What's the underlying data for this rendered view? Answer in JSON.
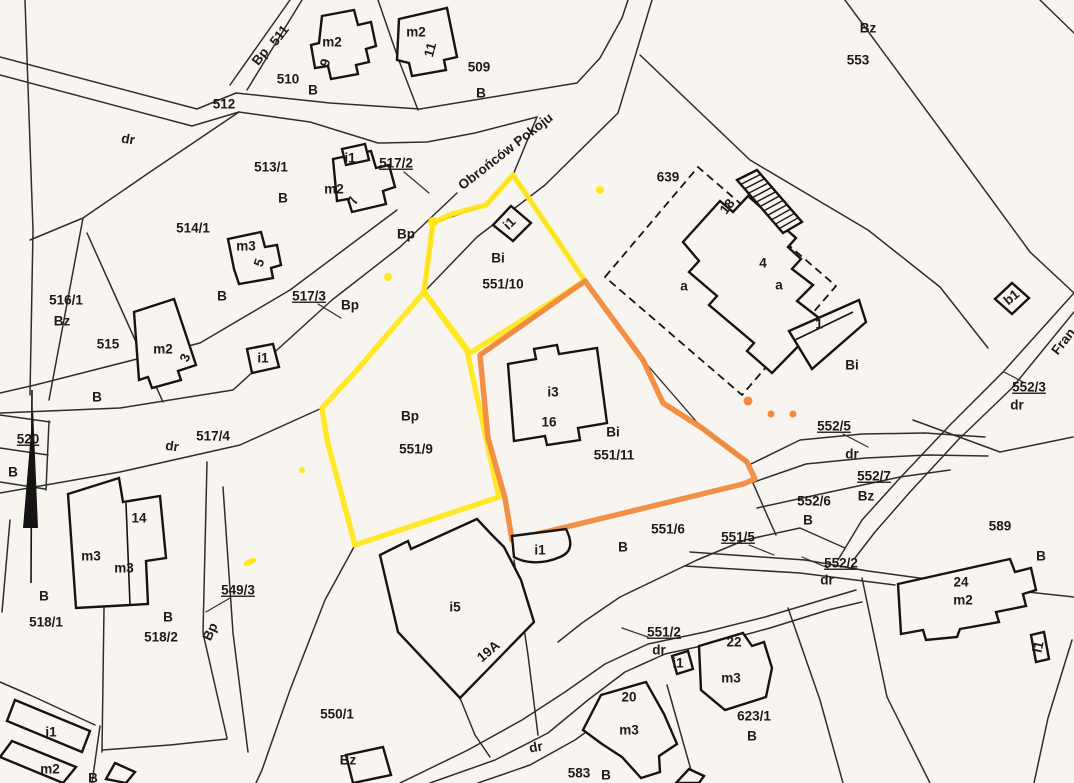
{
  "colors": {
    "paper": "#f8f5f1",
    "line": "#2e2e2e",
    "building": "#141414",
    "yellow": "#ffe71e",
    "orange": "#f18a3d"
  },
  "map": {
    "highlighted_parcels": {
      "yellow": [
        "551/9",
        "551/10"
      ],
      "orange": [
        "551/11"
      ]
    },
    "street_name": "Obrońców Pokoju",
    "labels": [
      {
        "t": "Bp",
        "x": 261,
        "y": 57,
        "r": -52
      },
      {
        "t": "511",
        "x": 280,
        "y": 36,
        "r": -52
      },
      {
        "t": "m2",
        "x": 332,
        "y": 43
      },
      {
        "t": "9",
        "x": 326,
        "y": 63,
        "r": -75,
        "s": 12.5
      },
      {
        "t": "m2",
        "x": 416,
        "y": 33
      },
      {
        "t": "11",
        "x": 431,
        "y": 50,
        "r": -75,
        "s": 12.5
      },
      {
        "t": "509",
        "x": 479,
        "y": 68
      },
      {
        "t": "B",
        "x": 481,
        "y": 94
      },
      {
        "t": "510",
        "x": 288,
        "y": 80
      },
      {
        "t": "B",
        "x": 313,
        "y": 91
      },
      {
        "t": "512",
        "x": 224,
        "y": 105
      },
      {
        "t": "dr",
        "x": 128,
        "y": 140,
        "r": 10
      },
      {
        "t": "513/1",
        "x": 271,
        "y": 168
      },
      {
        "t": "B",
        "x": 283,
        "y": 199
      },
      {
        "t": "i1",
        "x": 350,
        "y": 159,
        "s": 12.5
      },
      {
        "t": "m2",
        "x": 334,
        "y": 190
      },
      {
        "t": "7",
        "x": 354,
        "y": 201,
        "r": -70,
        "s": 12.5
      },
      {
        "t": "517/2",
        "x": 396,
        "y": 164,
        "ul": 1
      },
      {
        "t": "Obrońców Pokoju",
        "x": 506,
        "y": 152,
        "r": -38
      },
      {
        "t": "514/1",
        "x": 193,
        "y": 229
      },
      {
        "t": "m3",
        "x": 246,
        "y": 247
      },
      {
        "t": "5",
        "x": 260,
        "y": 263,
        "r": -70,
        "s": 12.5
      },
      {
        "t": "B",
        "x": 222,
        "y": 297
      },
      {
        "t": "517/3",
        "x": 309,
        "y": 297,
        "ul": 1
      },
      {
        "t": "Bp",
        "x": 350,
        "y": 306
      },
      {
        "t": "Bp",
        "x": 406,
        "y": 235
      },
      {
        "t": "516/1",
        "x": 66,
        "y": 301
      },
      {
        "t": "Bz",
        "x": 62,
        "y": 322
      },
      {
        "t": "515",
        "x": 108,
        "y": 345
      },
      {
        "t": "m2",
        "x": 163,
        "y": 350
      },
      {
        "t": "3",
        "x": 186,
        "y": 358,
        "r": -70,
        "s": 12.5
      },
      {
        "t": "i1",
        "x": 263,
        "y": 359,
        "s": 12.5
      },
      {
        "t": "B",
        "x": 97,
        "y": 398
      },
      {
        "t": "520",
        "x": 28,
        "y": 440,
        "ul": 1
      },
      {
        "t": "B",
        "x": 13,
        "y": 473
      },
      {
        "t": "517/4",
        "x": 213,
        "y": 437
      },
      {
        "t": "dr",
        "x": 172,
        "y": 447,
        "r": 8
      },
      {
        "t": "Bz",
        "x": 868,
        "y": 29
      },
      {
        "t": "553",
        "x": 858,
        "y": 61
      },
      {
        "t": "639",
        "x": 668,
        "y": 178
      },
      {
        "t": "18",
        "x": 728,
        "y": 207,
        "r": -52,
        "s": 12.5
      },
      {
        "t": "a",
        "x": 684,
        "y": 287
      },
      {
        "t": "4",
        "x": 763,
        "y": 264
      },
      {
        "t": "a",
        "x": 779,
        "y": 286
      },
      {
        "t": "1",
        "x": 819,
        "y": 325
      },
      {
        "t": "Bi",
        "x": 852,
        "y": 366
      },
      {
        "t": "i1",
        "x": 510,
        "y": 224,
        "r": -45,
        "s": 12.5
      },
      {
        "t": "Bi",
        "x": 498,
        "y": 259
      },
      {
        "t": "551/10",
        "x": 503,
        "y": 285
      },
      {
        "t": "Bp",
        "x": 410,
        "y": 417
      },
      {
        "t": "551/9",
        "x": 416,
        "y": 450
      },
      {
        "t": "i3",
        "x": 553,
        "y": 393
      },
      {
        "t": "16",
        "x": 549,
        "y": 423
      },
      {
        "t": "Bi",
        "x": 613,
        "y": 433
      },
      {
        "t": "551/11",
        "x": 614,
        "y": 456
      },
      {
        "t": "b1",
        "x": 1012,
        "y": 298,
        "r": -40,
        "s": 12.5
      },
      {
        "t": "552/3",
        "x": 1029,
        "y": 388,
        "ul": 1
      },
      {
        "t": "dr",
        "x": 1017,
        "y": 406
      },
      {
        "t": "Fran",
        "x": 1064,
        "y": 342,
        "r": -52
      },
      {
        "t": "552/5",
        "x": 834,
        "y": 427,
        "ul": 1
      },
      {
        "t": "dr",
        "x": 852,
        "y": 455
      },
      {
        "t": "552/7",
        "x": 874,
        "y": 477,
        "ul": 1
      },
      {
        "t": "Bz",
        "x": 866,
        "y": 497
      },
      {
        "t": "552/6",
        "x": 814,
        "y": 502
      },
      {
        "t": "B",
        "x": 808,
        "y": 521
      },
      {
        "t": "551/5",
        "x": 738,
        "y": 538,
        "ul": 1
      },
      {
        "t": "552/2",
        "x": 841,
        "y": 564,
        "ul": 1
      },
      {
        "t": "dr",
        "x": 827,
        "y": 581
      },
      {
        "t": "589",
        "x": 1000,
        "y": 527
      },
      {
        "t": "B",
        "x": 1041,
        "y": 557
      },
      {
        "t": "24",
        "x": 961,
        "y": 583
      },
      {
        "t": "m2",
        "x": 963,
        "y": 601
      },
      {
        "t": "i1",
        "x": 1039,
        "y": 647,
        "r": -78,
        "s": 12.5
      },
      {
        "t": "551/6",
        "x": 668,
        "y": 530
      },
      {
        "t": "B",
        "x": 623,
        "y": 548
      },
      {
        "t": "i1",
        "x": 540,
        "y": 551,
        "s": 12.5
      },
      {
        "t": "i5",
        "x": 455,
        "y": 608
      },
      {
        "t": "19A",
        "x": 489,
        "y": 652,
        "r": -40,
        "s": 12.5
      },
      {
        "t": "551/2",
        "x": 664,
        "y": 633,
        "ul": 1
      },
      {
        "t": "dr",
        "x": 659,
        "y": 651
      },
      {
        "t": "i1",
        "x": 678,
        "y": 664,
        "s": 12.5
      },
      {
        "t": "22",
        "x": 734,
        "y": 643
      },
      {
        "t": "m3",
        "x": 731,
        "y": 679
      },
      {
        "t": "20",
        "x": 629,
        "y": 698
      },
      {
        "t": "m3",
        "x": 629,
        "y": 731
      },
      {
        "t": "623/1",
        "x": 754,
        "y": 717
      },
      {
        "t": "B",
        "x": 752,
        "y": 737
      },
      {
        "t": "583",
        "x": 579,
        "y": 774
      },
      {
        "t": "B",
        "x": 606,
        "y": 776
      },
      {
        "t": "dr",
        "x": 536,
        "y": 748,
        "r": -10
      },
      {
        "t": "549/3",
        "x": 238,
        "y": 591,
        "ul": 1
      },
      {
        "t": "Bp",
        "x": 211,
        "y": 632,
        "r": -65
      },
      {
        "t": "B",
        "x": 44,
        "y": 597
      },
      {
        "t": "518/1",
        "x": 46,
        "y": 623
      },
      {
        "t": "B",
        "x": 168,
        "y": 618
      },
      {
        "t": "518/2",
        "x": 161,
        "y": 638
      },
      {
        "t": "14",
        "x": 139,
        "y": 519
      },
      {
        "t": "m3",
        "x": 91,
        "y": 557
      },
      {
        "t": "m3",
        "x": 124,
        "y": 569
      },
      {
        "t": "550/1",
        "x": 337,
        "y": 715
      },
      {
        "t": "Bz",
        "x": 348,
        "y": 761
      },
      {
        "t": "i1",
        "x": 51,
        "y": 733,
        "s": 12.5
      },
      {
        "t": "m2",
        "x": 50,
        "y": 770
      },
      {
        "t": "B",
        "x": 93,
        "y": 779
      }
    ],
    "dots": {
      "yellow": [
        {
          "x": 600,
          "y": 190,
          "r": 4
        },
        {
          "x": 433,
          "y": 222,
          "r": 5
        },
        {
          "x": 388,
          "y": 277,
          "r": 4
        },
        {
          "x": 302,
          "y": 470,
          "r": 3
        }
      ],
      "yellow_dash": {
        "x": 250,
        "y": 562,
        "rx": 7,
        "ry": 3,
        "rot": -25
      },
      "orange": [
        {
          "x": 748,
          "y": 401,
          "r": 4.5
        },
        {
          "x": 771,
          "y": 414,
          "r": 3.5
        },
        {
          "x": 793,
          "y": 414,
          "r": 3.5
        }
      ]
    }
  }
}
